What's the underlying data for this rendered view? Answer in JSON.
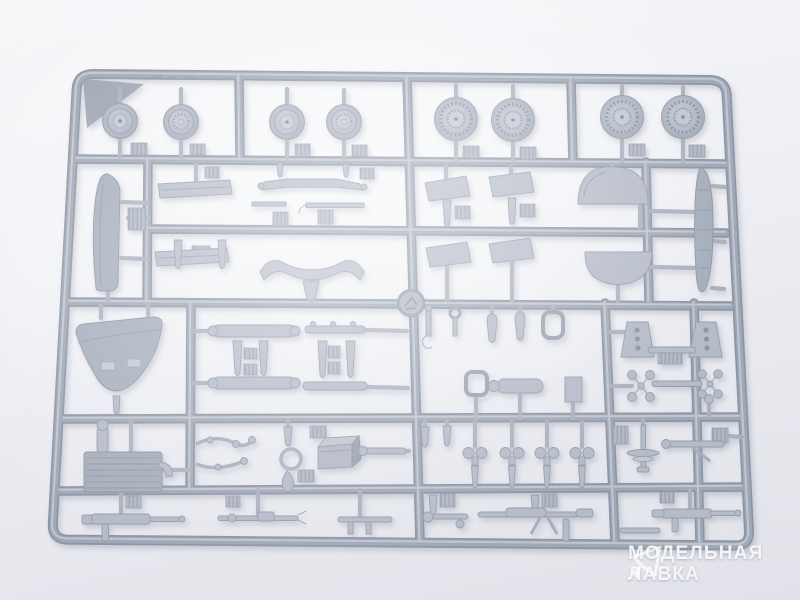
{
  "image": {
    "type": "product-photo",
    "subject": "grey injection-moulded model kit sprue with aircraft parts on light backdrop"
  },
  "colors": {
    "background_top": "#f6f6f9",
    "background_bottom": "#e1e2e9",
    "sprue_base": "#8c95a5",
    "sprue_mid": "#a0a8b6",
    "sprue_highlight": "#c6ccd6",
    "part_fill": "#b5bbc8",
    "shadow": "#7d8598",
    "watermark_text": "#ffffff"
  },
  "sprue": {
    "medallion": "manufacturer-logo-medallion",
    "parts_summary": [
      {
        "group": "small-wheels",
        "count": 4
      },
      {
        "group": "large-treaded-wheels",
        "count": 4
      },
      {
        "group": "tail-fin",
        "count": 1
      },
      {
        "group": "stabilizer-panels",
        "count": 8
      },
      {
        "group": "dome-fairings",
        "count": 2
      },
      {
        "group": "fuselage-spine",
        "count": 1
      },
      {
        "group": "engine-cowling",
        "count": 1
      },
      {
        "group": "cylinder-assemblies",
        "count": 4
      },
      {
        "group": "engine-block",
        "count": 1
      },
      {
        "group": "cockpit-box",
        "count": 1
      },
      {
        "group": "machine-guns-and-rods",
        "count": 6
      },
      {
        "group": "small-fittings",
        "count": 40
      }
    ]
  },
  "watermark": {
    "line1": "МОДЕЛЬНАЯ",
    "line2": "ЛАВКА",
    "logo": "paper-plane-icon"
  }
}
